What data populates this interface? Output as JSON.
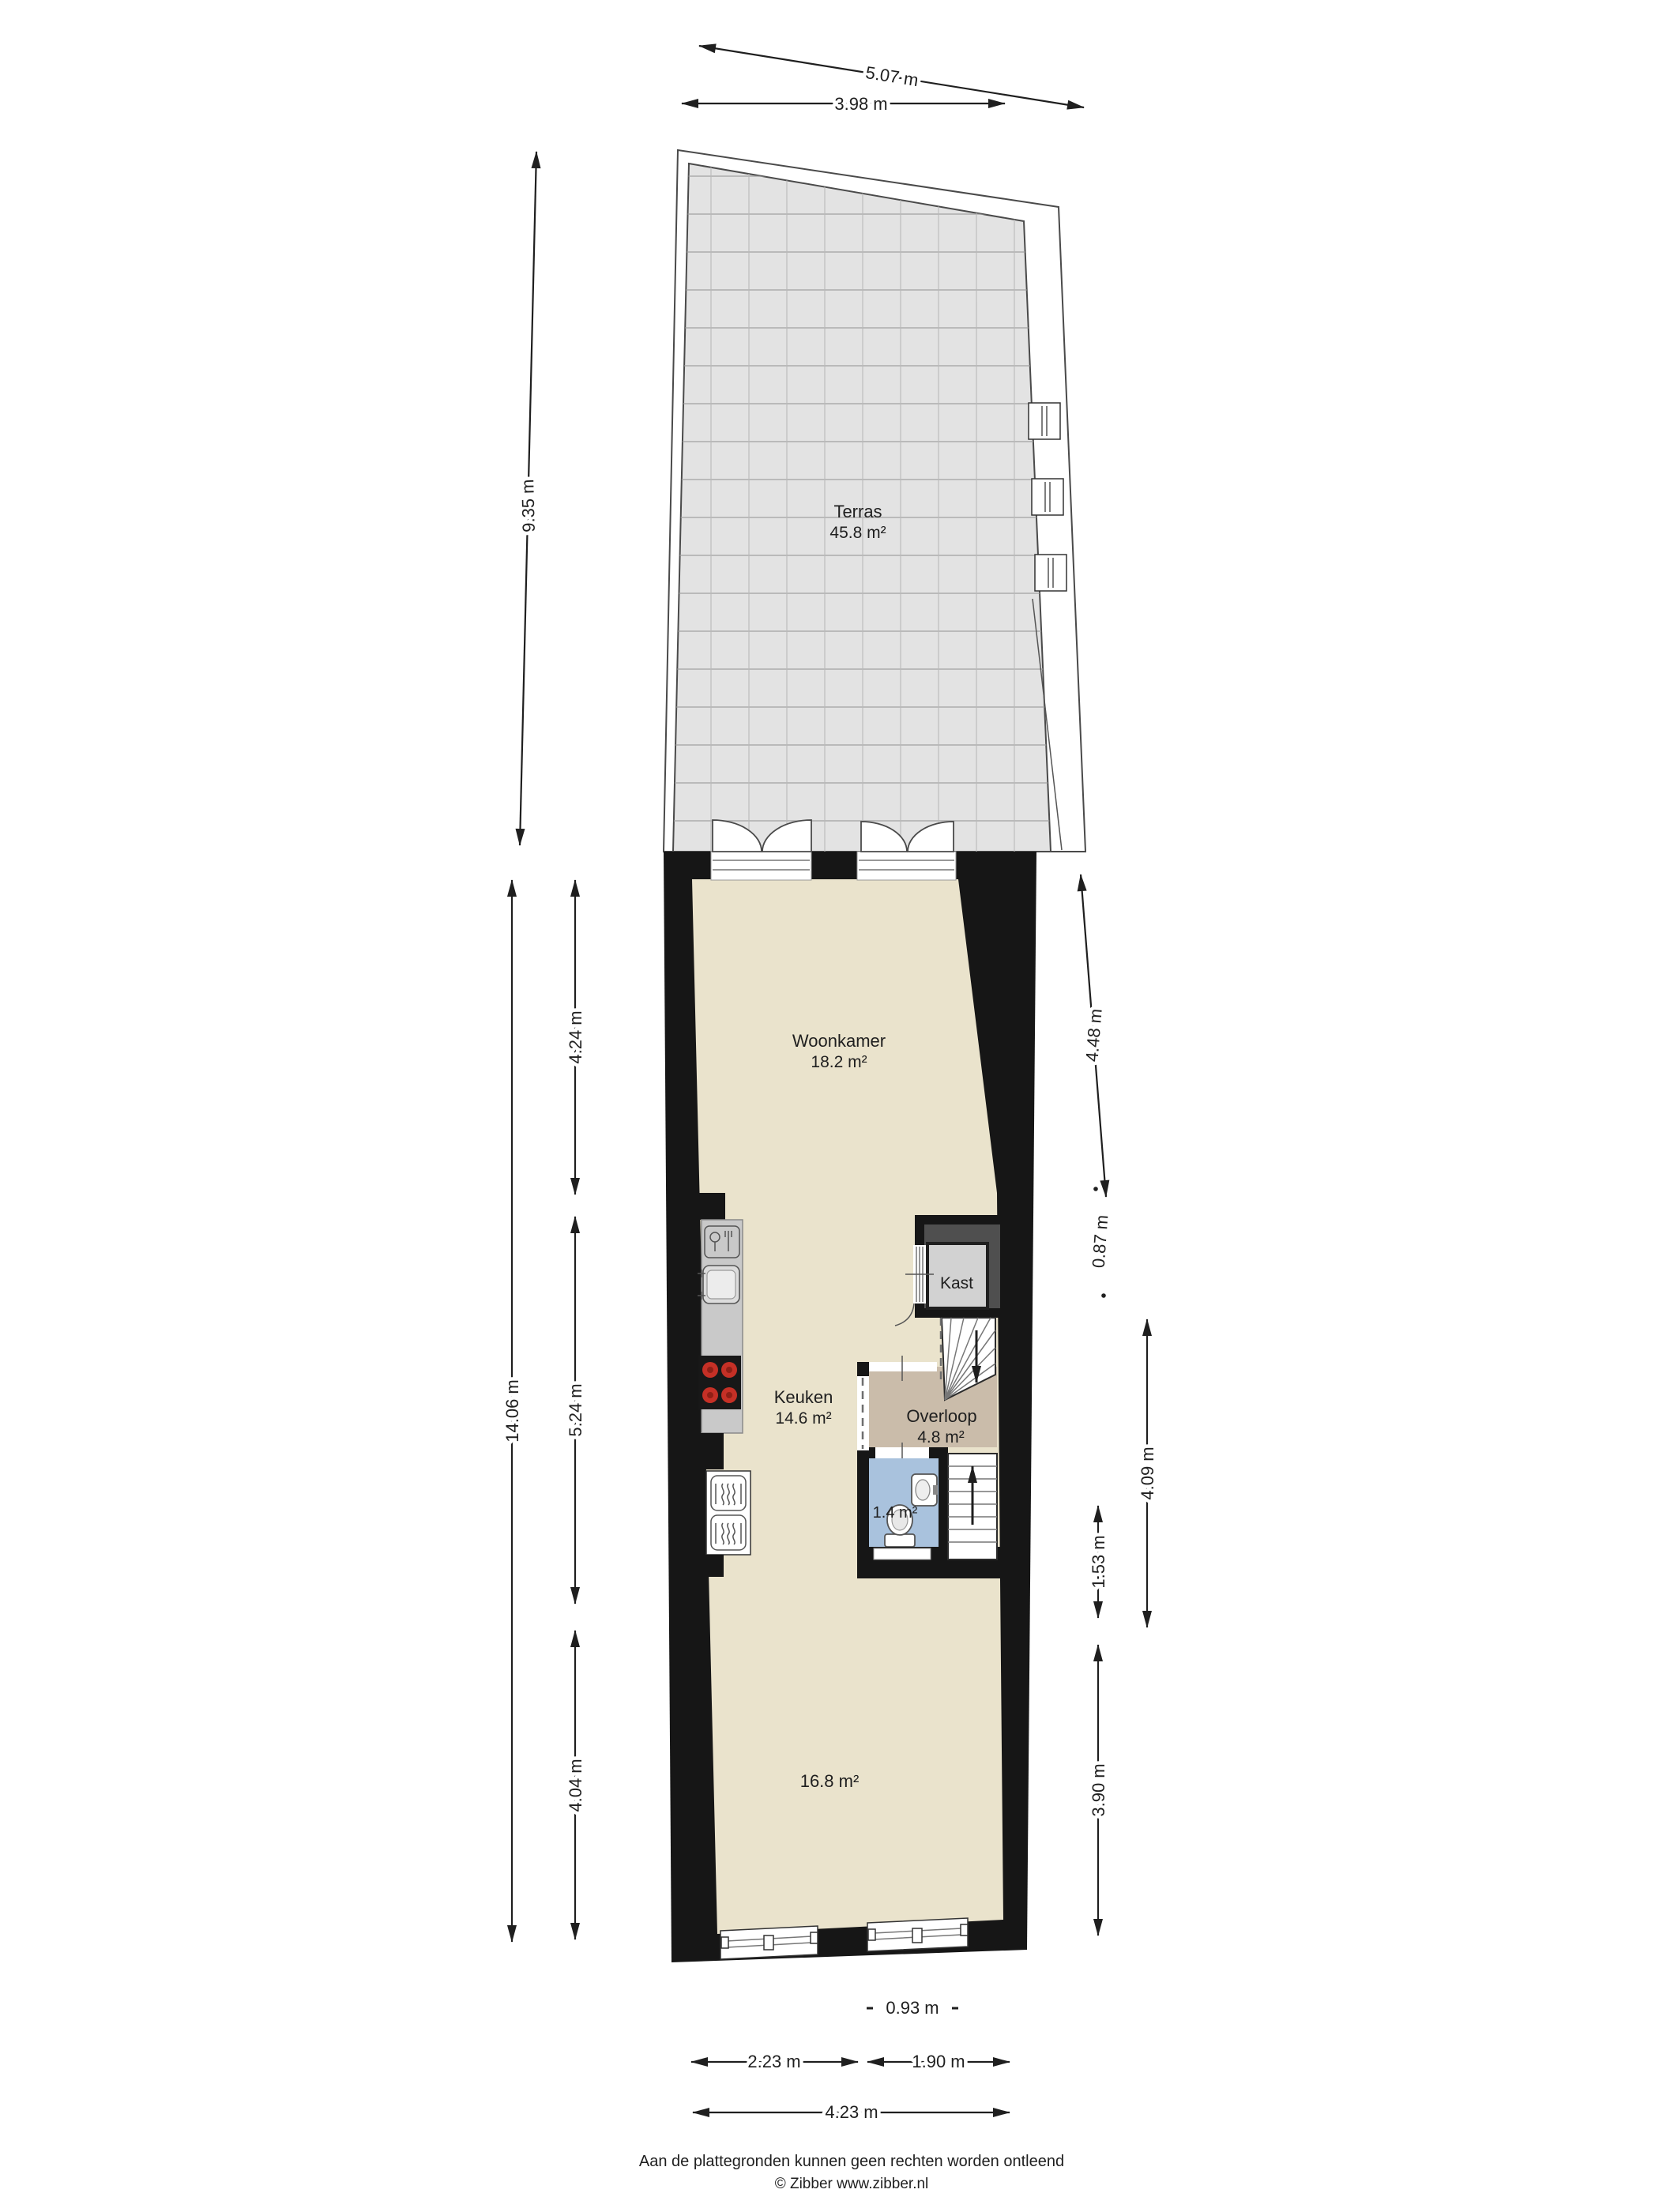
{
  "plan": {
    "rooms": {
      "terras": {
        "name": "Terras",
        "area": "45.8 m²"
      },
      "woonkamer": {
        "name": "Woonkamer",
        "area": "18.2 m²"
      },
      "keuken": {
        "name": "Keuken",
        "area": "14.6 m²"
      },
      "kast": {
        "name": "Kast"
      },
      "overloop": {
        "name": "Overloop",
        "area": "4.8 m²"
      },
      "toilet": {
        "area": "1.4 m²"
      },
      "achterkamer": {
        "area": "16.8 m²"
      }
    },
    "dimensions": {
      "terras_breedte_schuin": "5.07 m",
      "terras_breedte": "3.98 m",
      "terras_lengte": "9.35 m",
      "totaal_links": "14.06 m",
      "woonkamer_links": "4.24 m",
      "keuken_links": "5.24 m",
      "achterkamer_links": "4.04 m",
      "woonkamer_rechts": "4.48 m",
      "kast_rechts": "0.87 m",
      "trap_rechts": "4.09 m",
      "toilet_rechts": "1.53 m",
      "achterkamer_rechts": "3.90 m",
      "penant_onder": "0.93 m",
      "onder_links": "2.23 m",
      "onder_rechts": "1.90 m",
      "onder_totaal": "4.23 m"
    },
    "footer": {
      "disclaimer": "Aan de plattegronden kunnen geen rechten worden ontleend",
      "copyright": "© Zibber www.zibber.nl"
    },
    "colors": {
      "wall": "#161616",
      "floor": "#eae3cc",
      "terrace": "#e3e3e3",
      "terrace-grid": "#9f9f9f",
      "overloop": "#cabcaa",
      "toilet": "#a9c2dd",
      "kast-floor": "#d2d2d2",
      "kast-wall": "#4f4f4f",
      "counter": "#c9c9c9",
      "burner": "#c53026",
      "outline": "#4a4a4a",
      "ink": "#1f1f1f"
    }
  }
}
